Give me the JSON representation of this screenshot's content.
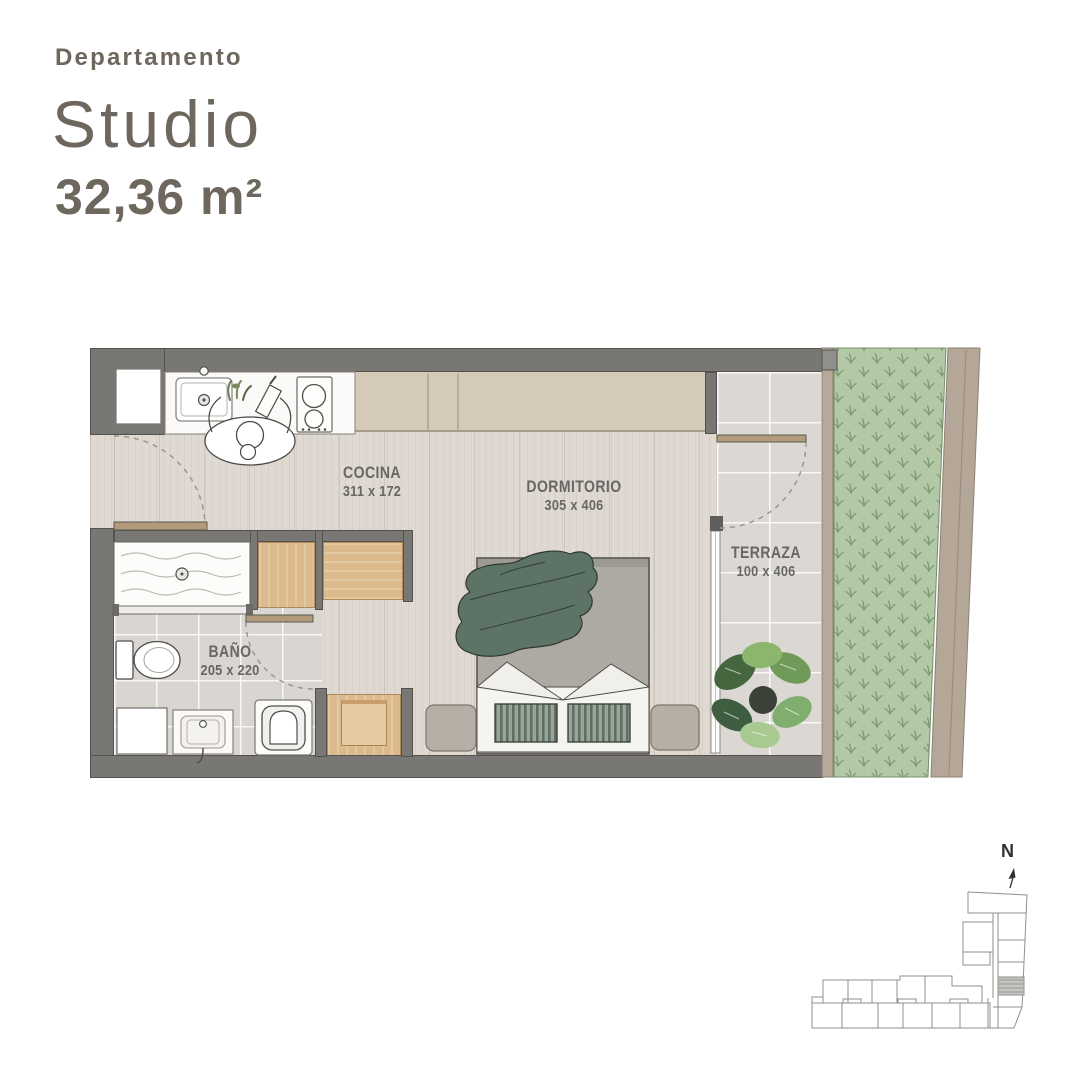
{
  "header": {
    "type_label": "Departamento",
    "name": "Studio",
    "area": "32,36 m²"
  },
  "rooms": {
    "cocina": {
      "label": "COCINA",
      "dims": "311 x 172"
    },
    "dormitorio": {
      "label": "DORMITORIO",
      "dims": "305 x 406"
    },
    "terraza": {
      "label": "TERRAZA",
      "dims": "100 x 406"
    },
    "bano": {
      "label": "BAÑO",
      "dims": "205 x 220"
    }
  },
  "compass": {
    "north_label": "N"
  },
  "colors": {
    "title_text": "#6e675d",
    "label_text": "#676765",
    "wall": "#787774",
    "wood_floor": "#dfd9d1",
    "tile_floor": "#d9d5d0",
    "cabinet_beige": "#d5cab7",
    "furniture_wood": "#dcba8e",
    "bed_blanket_green": "#5d7365",
    "cushion_green": "#97a698",
    "garden_green": "#b2c8a6",
    "garden_mark_green": "#7c9a71",
    "path_tan": "#b7a99a"
  }
}
